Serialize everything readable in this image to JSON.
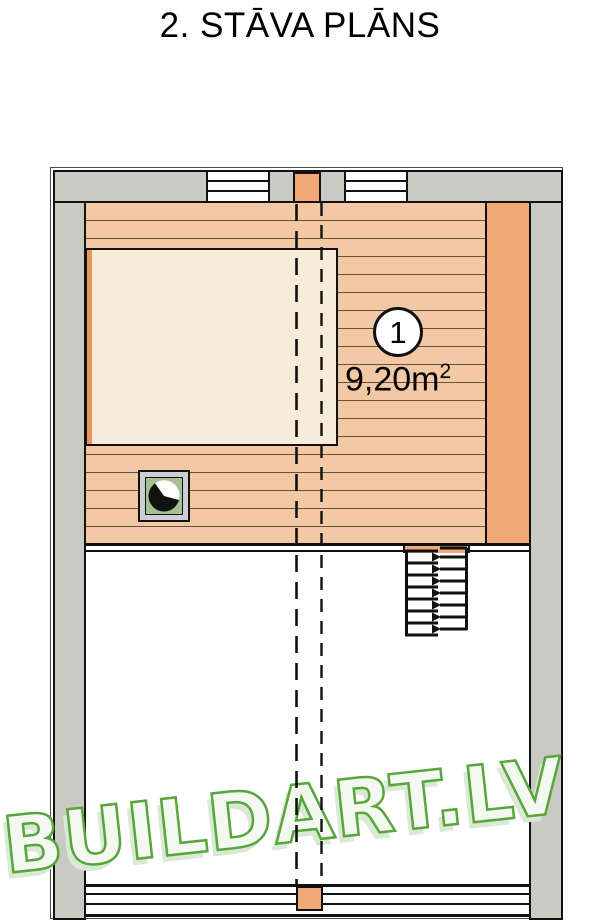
{
  "page": {
    "title": "2. STĀVA PLĀNS"
  },
  "plan": {
    "room": {
      "number": "1",
      "area": "9,20m",
      "area_sup": "2"
    },
    "watermark": "BUILDART.LV",
    "colors": {
      "wall_gray": "#c9cbc3",
      "floor": "#f2c9a4",
      "plank_line": "#6b4f3d",
      "accent_orange": "#f2a877",
      "loft_beige": "#f6ecd9",
      "loft_edge_orange": "#e9975c",
      "flue_frame_gray": "#cdced2",
      "flue_green": "#a4c193",
      "watermark_green": "#58a53e",
      "watermark_fill": "#f3f8f0",
      "watermark_shadow": "#d9e9d3"
    }
  }
}
